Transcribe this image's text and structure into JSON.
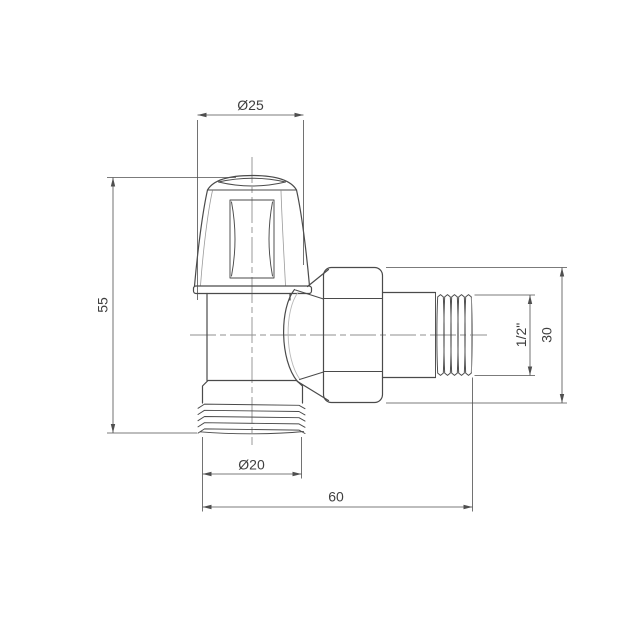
{
  "page": {
    "background": "#ffffff"
  },
  "drawing": {
    "colors": {
      "outline": "#4a4a4a",
      "dimension_lines": "#4f4f4f",
      "centerline": "#8f8f8f",
      "highlight_edge": "#b8b8b8",
      "label_text": "#3f3f3f",
      "background": "#ffffff"
    },
    "dimensions": [
      {
        "id": "knob-diameter",
        "label": "Ø25",
        "value": 25,
        "orientation": "horizontal"
      },
      {
        "id": "valve-height",
        "label": "55",
        "value": 55,
        "orientation": "vertical"
      },
      {
        "id": "tail-diameter",
        "label": "Ø20",
        "value": 20,
        "orientation": "horizontal"
      },
      {
        "id": "overall-length",
        "label": "60",
        "value": 60,
        "orientation": "horizontal"
      },
      {
        "id": "thread-size",
        "label": "1/2\"",
        "orientation": "vertical"
      },
      {
        "id": "outlet-height",
        "label": "30",
        "value": 30,
        "orientation": "vertical"
      }
    ]
  }
}
